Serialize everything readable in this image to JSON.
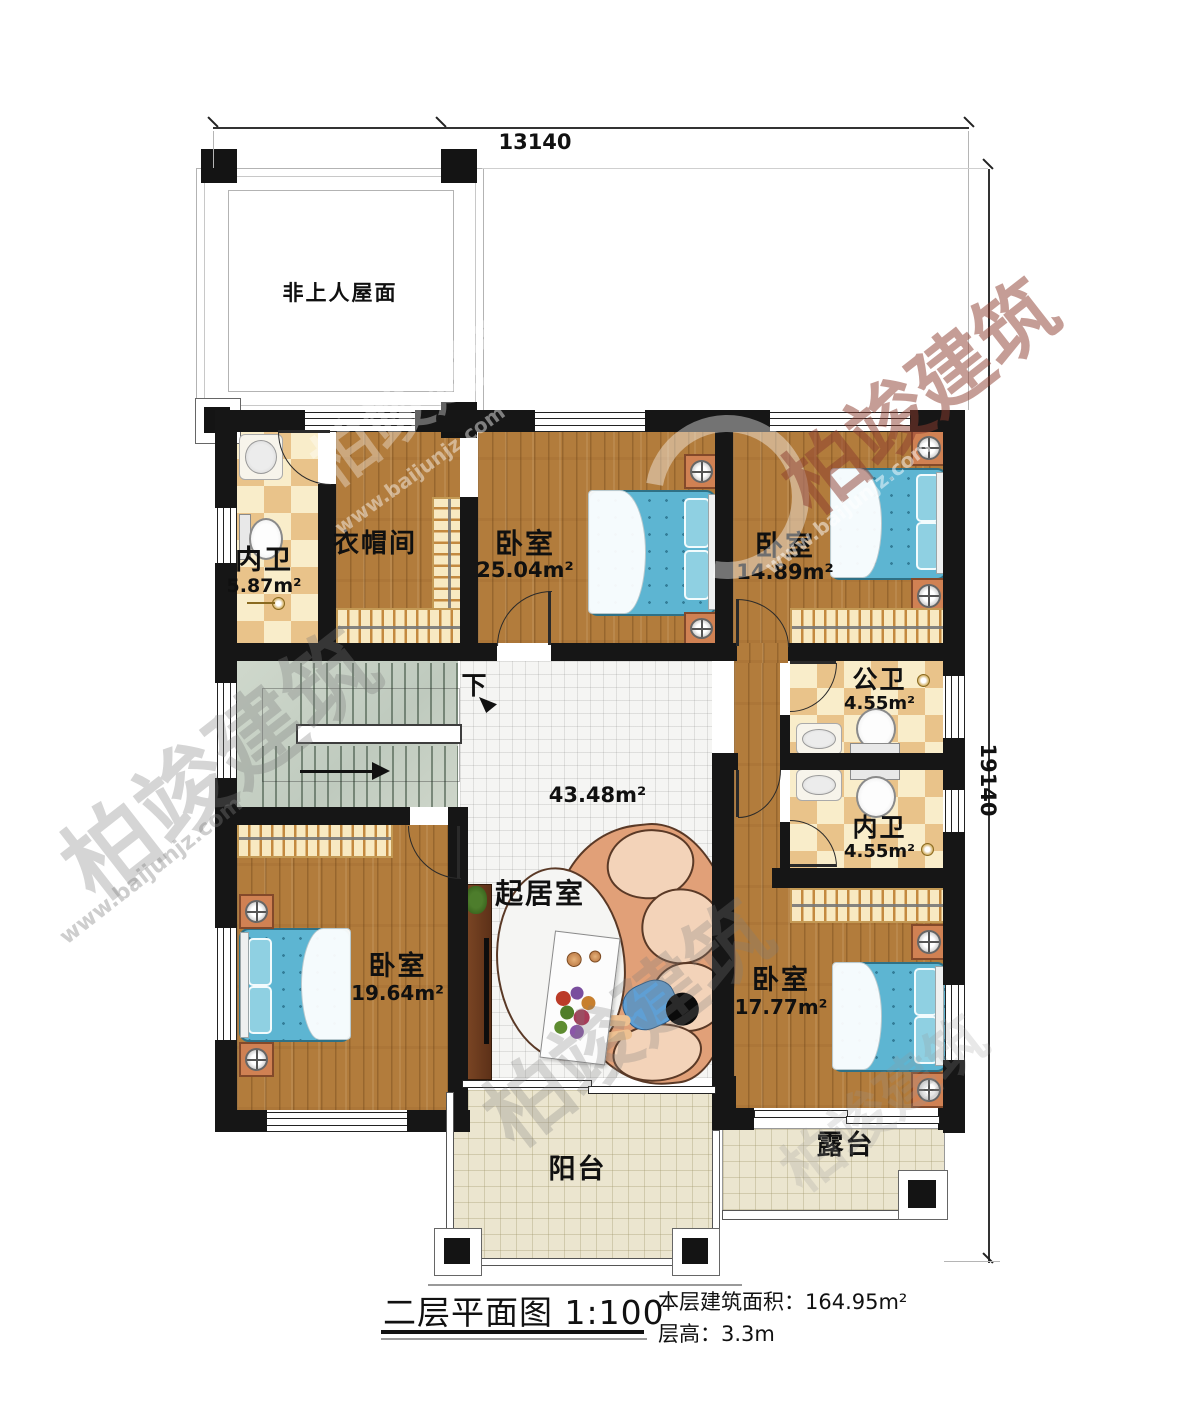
{
  "title_block": {
    "title": "二层平面图",
    "scale": "1:100",
    "area_label": "本层建筑面积：",
    "area_value": "164.95m²",
    "height_label": "层高：",
    "height_value": "3.3m"
  },
  "dimensions": {
    "top": "13140",
    "right": "19140"
  },
  "rooms": {
    "roof": {
      "label": "非上人屋面"
    },
    "bath_master": {
      "label": "内卫",
      "area": "5.87m²"
    },
    "cloakroom": {
      "label": "衣帽间"
    },
    "bedroom_a": {
      "label": "卧室",
      "area": "25.04m²"
    },
    "bedroom_b": {
      "label": "卧室",
      "area": "14.89m²"
    },
    "bath_public": {
      "label": "公卫",
      "area": "4.55m²"
    },
    "bath_inner": {
      "label": "内卫",
      "area": "4.55m²"
    },
    "living": {
      "label": "起居室",
      "area": "43.48m²"
    },
    "bedroom_c": {
      "label": "卧室",
      "area": "19.64m²"
    },
    "bedroom_d": {
      "label": "卧室",
      "area": "17.77m²"
    },
    "balcony": {
      "label": "阳台"
    },
    "terrace": {
      "label": "露台"
    }
  },
  "stairs": {
    "down_label": "下"
  },
  "watermark": {
    "brand": "柏竣建筑",
    "url": "www.baijunjz.com"
  },
  "colors": {
    "wall": "#161616",
    "wood_floor": "#b27c3c",
    "bath_tile_dark": "#e9c38a",
    "bath_tile_light": "#f9edca",
    "bed_blue": "#5db5d2",
    "stairs_green": "#c9d2c6",
    "living_tile": "#f5f5f3",
    "patio_tile": "#ebe5cf",
    "sofa_salmon": "#e1a078"
  }
}
